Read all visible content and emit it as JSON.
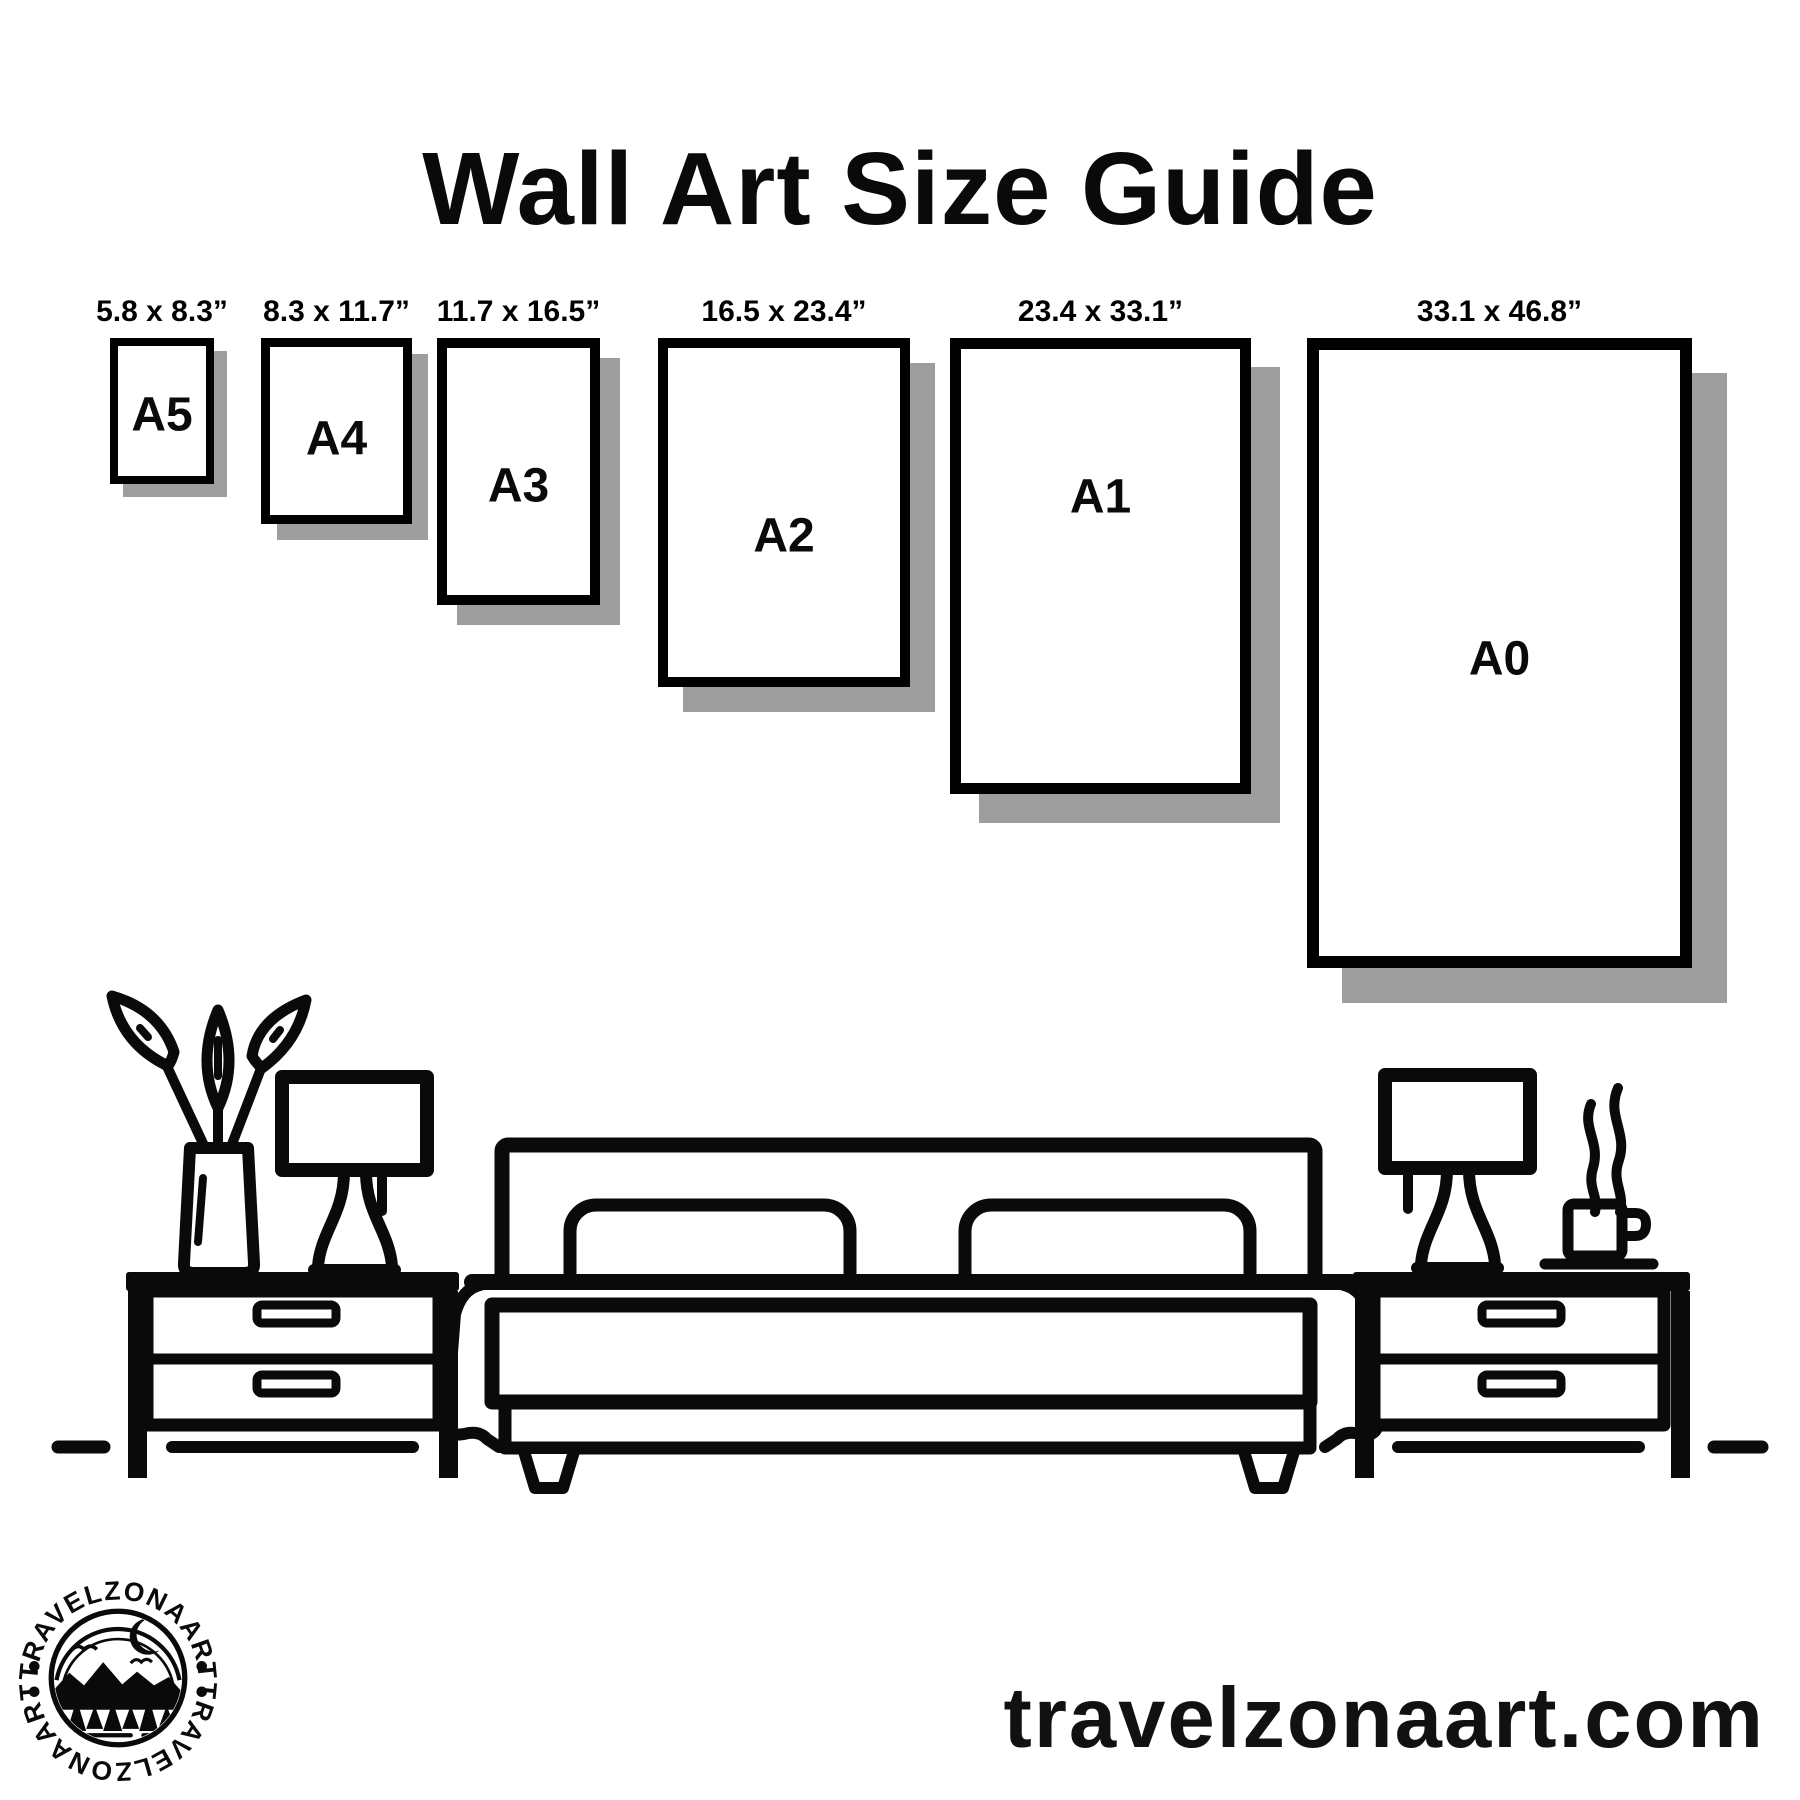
{
  "title": "Wall Art Size Guide",
  "sizes": [
    {
      "name": "A5",
      "dimensions": "5.8 x 8.3”",
      "box": {
        "x": 110,
        "w": 104,
        "h": 146,
        "border": 8,
        "shadow": 13,
        "letter_frac": 0.53
      }
    },
    {
      "name": "A4",
      "dimensions": "8.3 x 11.7”",
      "box": {
        "x": 261,
        "w": 151,
        "h": 186,
        "border": 9,
        "shadow": 16,
        "letter_frac": 0.55
      }
    },
    {
      "name": "A3",
      "dimensions": "11.7 x 16.5”",
      "box": {
        "x": 437,
        "w": 163,
        "h": 267,
        "border": 10,
        "shadow": 20,
        "letter_frac": 0.56
      }
    },
    {
      "name": "A2",
      "dimensions": "16.5 x 23.4”",
      "box": {
        "x": 658,
        "w": 252,
        "h": 349,
        "border": 10,
        "shadow": 25,
        "letter_frac": 0.57
      }
    },
    {
      "name": "A1",
      "dimensions": "23.4 x 33.1”",
      "box": {
        "x": 950,
        "w": 301,
        "h": 456,
        "border": 11,
        "shadow": 29,
        "letter_frac": 0.34
      }
    },
    {
      "name": "A0",
      "dimensions": "33.1 x 46.8”",
      "box": {
        "x": 1307,
        "w": 385,
        "h": 630,
        "border": 12,
        "shadow": 35,
        "letter_frac": 0.51
      }
    }
  ],
  "logo": {
    "arc_text": "TRAVELZONAART"
  },
  "website": "travelzonaart.com",
  "colors": {
    "ink": "#0a0a0a",
    "shadow": "#9e9e9e",
    "background": "#ffffff"
  }
}
